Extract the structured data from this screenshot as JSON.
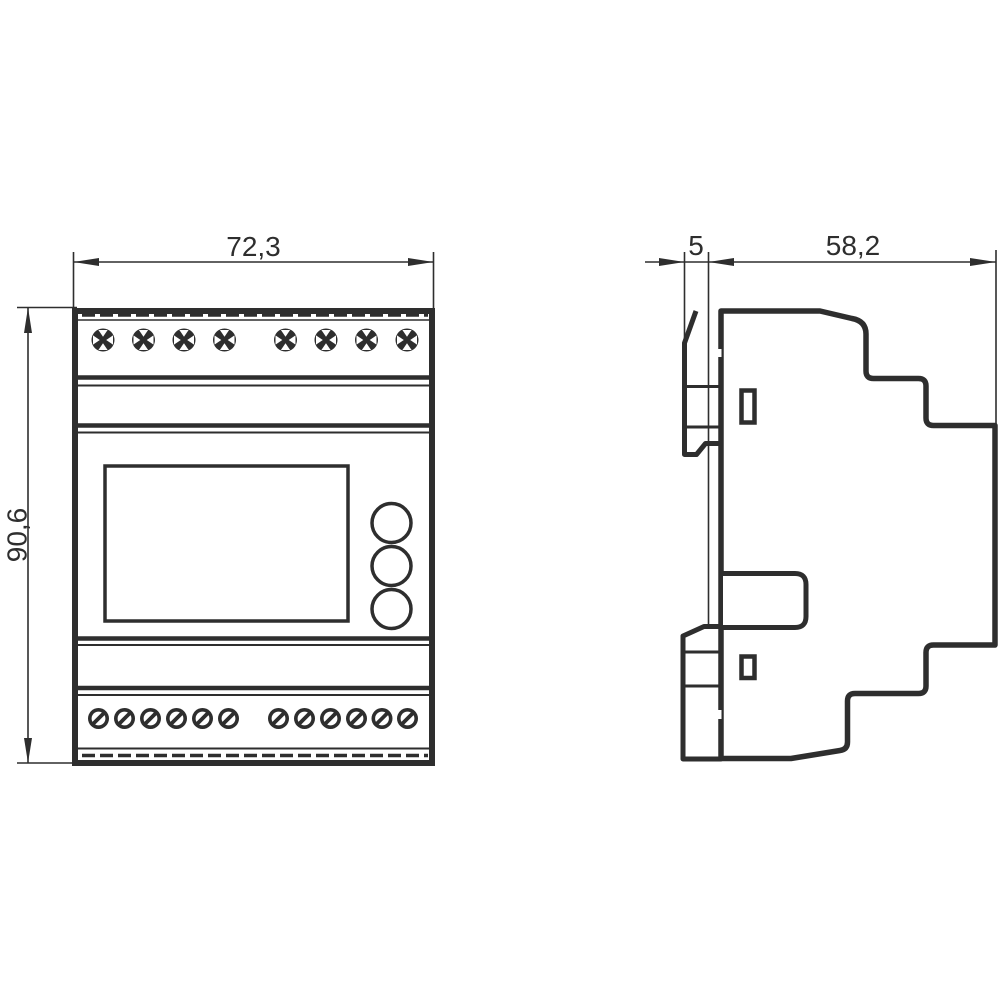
{
  "drawing": {
    "kind": "technical-dimension-drawing",
    "ink_color": "#2e2e2e",
    "background_color": "#ffffff",
    "front_view": {
      "width_label": "72,3",
      "height_label": "90,6",
      "top_screw_count": 8,
      "bottom_screw_count": 12,
      "button_count": 3
    },
    "side_view": {
      "front_offset_label": "5",
      "depth_label": "58,2",
      "slot_count": 2
    }
  }
}
